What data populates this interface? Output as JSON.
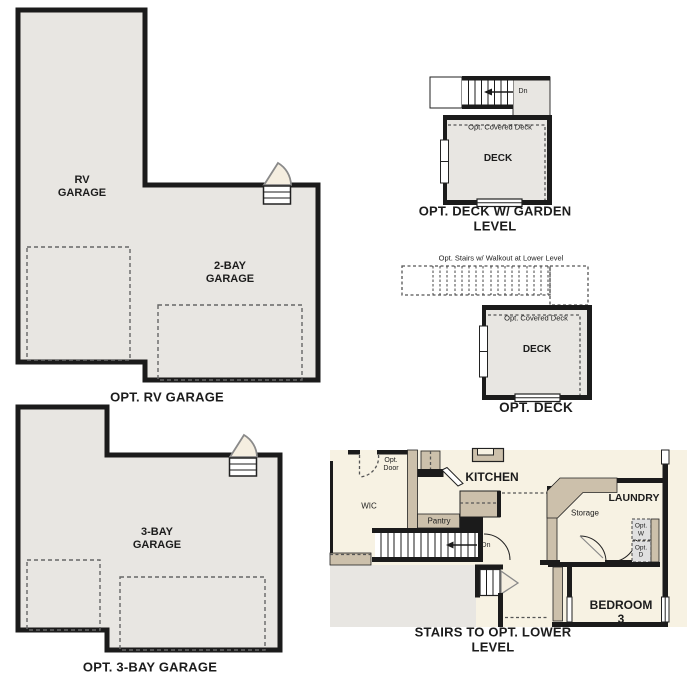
{
  "colors": {
    "wall": "#1b1b1b",
    "garage_fill": "#e8e6e2",
    "cream": "#f7f2e3",
    "tan": "#ccc0ab",
    "dash": "#666666",
    "door_fill": "#f5eee0",
    "door_stroke": "#8a8a8a"
  },
  "panels": {
    "rv_garage": {
      "rv_label": "RV\nGARAGE",
      "two_bay_label": "2-BAY\nGARAGE",
      "caption": "OPT. RV GARAGE"
    },
    "deck_garden": {
      "dn_label": "Dn",
      "covered_label": "Opt. Covered Deck",
      "deck_label": "DECK",
      "caption": "OPT. DECK W/ GARDEN LEVEL"
    },
    "opt_deck": {
      "stairs_note": "Opt. Stairs w/ Walkout at Lower Level",
      "covered_label": "Opt. Covered Deck",
      "deck_label": "DECK",
      "caption": "OPT. DECK"
    },
    "three_bay": {
      "label": "3-BAY\nGARAGE",
      "caption": "OPT. 3-BAY GARAGE"
    },
    "lower_level": {
      "opt_door_label": "Opt.\nDoor",
      "wic_label": "WIC",
      "kitchen_label": "KITCHEN",
      "pantry_label": "Pantry",
      "dn_label": "Dn",
      "storage_label": "Storage",
      "laundry_label": "LAUNDRY",
      "opt_w_label": "Opt.\nW",
      "opt_d_label": "Opt.\nD",
      "bedroom_label": "BEDROOM 3",
      "caption": "STAIRS TO OPT. LOWER LEVEL"
    }
  }
}
